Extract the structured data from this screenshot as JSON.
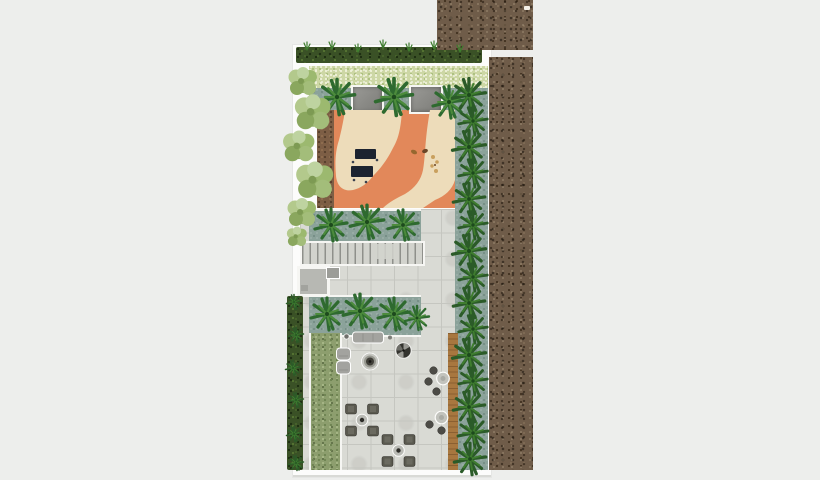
{
  "meta": {
    "title": "landscape-site-plan",
    "description": "Top-view architectural landscape plan of a narrow garden terrace: kids playground with curved walkway at top, central stairs, paved lounge and dining terrace below, palm planting beds, hedge borders and adjacent gravel roof areas.",
    "visible_text": []
  },
  "colors": {
    "background": "#edeeec",
    "sheet": "#fcfcfb",
    "sheet_edge": "#d9dad6",
    "gravel_base": "#6f5c49",
    "hedge_dark": "#3a5126",
    "groundcover": "#cdd7a5",
    "groundcover_dot": "#eef1d8",
    "groundcover_dot2": "#a9bd7d",
    "teal": "#8ba29a",
    "orange": "#e2885a",
    "cream": "#eddcba",
    "mulch": "#7d5e45",
    "paving": "#d9dad4",
    "paving_line": "#c5c6c0",
    "stairs_bg": "#d2d3cd",
    "stairs_line": "#8f908b",
    "deck": "#a8773f",
    "deck_line": "#8a5f31",
    "moss": "#8d9e6e",
    "moss_dot": "#6f8452",
    "moss_dot2": "#a9b989",
    "palm_dark": "#2e6a2f",
    "palm_light": "#4c8b3c",
    "palm_core": "#1d4a1d",
    "fern_dark": "#2b5b28",
    "fern_light": "#3f7d2f",
    "tree1": "#90ad63",
    "tree2": "#b3c98c",
    "tree3": "#9cb96f",
    "tree4": "#a3bd7a",
    "tree5": "#8aa75e",
    "tree6": "#bed3a0",
    "tree7": "#7d9a53",
    "canopy_a": "#9a9a96",
    "canopy_b": "#7b7b77",
    "white_line": "#f6f6f3",
    "furn_gray": "#a3a39f",
    "furn_gray_dark": "#8e8e89",
    "furn_dark": "#4c4b46",
    "chair": "#5a594f",
    "chair_stripe": "#77766c",
    "table_light": "#c2c3bd",
    "navy": "#1c2330",
    "toy_brown": "#96672f",
    "toy_tan": "#c9a05e",
    "marker": "#f3efe6"
  },
  "zones": [
    {
      "name": "gravel-roof-top"
    },
    {
      "name": "gravel-roof-strip"
    },
    {
      "name": "top-hedge-border"
    },
    {
      "name": "groundcover-bed"
    },
    {
      "name": "shade-canopies",
      "count": 2
    },
    {
      "name": "kids-playground"
    },
    {
      "name": "playground-walkway"
    },
    {
      "name": "palm-bed-upper"
    },
    {
      "name": "stairs"
    },
    {
      "name": "stair-landing-structure"
    },
    {
      "name": "palm-bed-lower"
    },
    {
      "name": "paved-terrace"
    },
    {
      "name": "moss-planting-strip"
    },
    {
      "name": "wood-deck-strip"
    },
    {
      "name": "palm-hedge-right"
    },
    {
      "name": "left-hedge-border"
    },
    {
      "name": "left-tree-row"
    }
  ],
  "furniture": {
    "sofa": 1,
    "armchairs": 2,
    "fire_pit": 1,
    "barbecue_grill": 1,
    "bistro_tables_with_stools": 2,
    "dining_sets_four_chairs": 2,
    "play_benches": 2,
    "spring_toys": 2
  }
}
